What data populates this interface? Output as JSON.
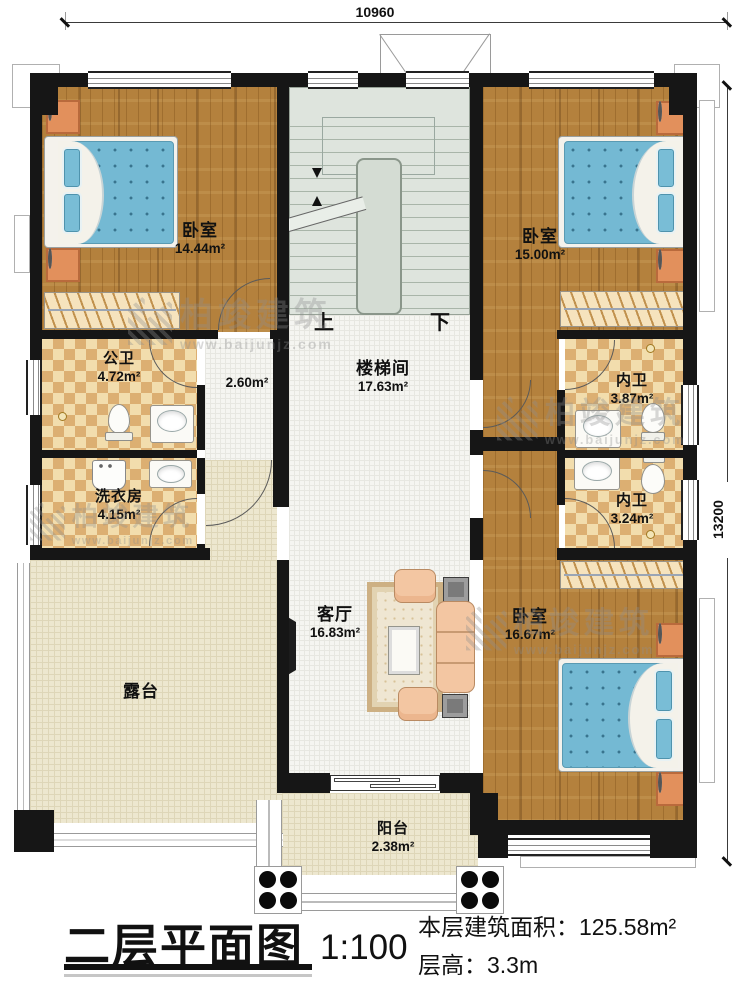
{
  "dimensions": {
    "width_mm": "10960",
    "height_mm": "13200"
  },
  "stairs": {
    "up_label": "上",
    "down_label": "下"
  },
  "rooms": {
    "bedroom_tl": {
      "name": "卧室",
      "area": "14.44m²"
    },
    "bedroom_tr": {
      "name": "卧室",
      "area": "15.00m²"
    },
    "bedroom_br": {
      "name": "卧室",
      "area": "16.67m²"
    },
    "public_bath": {
      "name": "公卫",
      "area": "4.72m²"
    },
    "hall": {
      "area": "2.60m²"
    },
    "stairwell": {
      "name": "楼梯间",
      "area": "17.63m²"
    },
    "ensuite_top": {
      "name": "内卫",
      "area": "3.87m²"
    },
    "ensuite_bottom": {
      "name": "内卫",
      "area": "3.24m²"
    },
    "laundry": {
      "name": "洗衣房",
      "area": "4.15m²"
    },
    "living": {
      "name": "客厅",
      "area": "16.83m²"
    },
    "terrace": {
      "name": "露台"
    },
    "balcony": {
      "name": "阳台",
      "area": "2.38m²"
    }
  },
  "title_block": {
    "plan_title": "二层平面图",
    "scale": "1:100",
    "area_label": "本层建筑面积：",
    "area_value": "125.58m²",
    "height_label": "层高：",
    "height_value": "3.3m"
  },
  "watermark": {
    "brand": "柏竣建筑",
    "url": "www.baijunjz.com"
  },
  "colors": {
    "wall": "#161616",
    "wood_floor": "#b4813d",
    "bath_tile": "#f2ddad",
    "bath_tile_dark": "#dcaf72",
    "white_tile": "#f5f5f1",
    "terrace_tile": "#ede7cf",
    "stair_floor": "#dee4dd",
    "bed_blue": "#74b9d3",
    "nightstand_orange": "#e2905c"
  }
}
